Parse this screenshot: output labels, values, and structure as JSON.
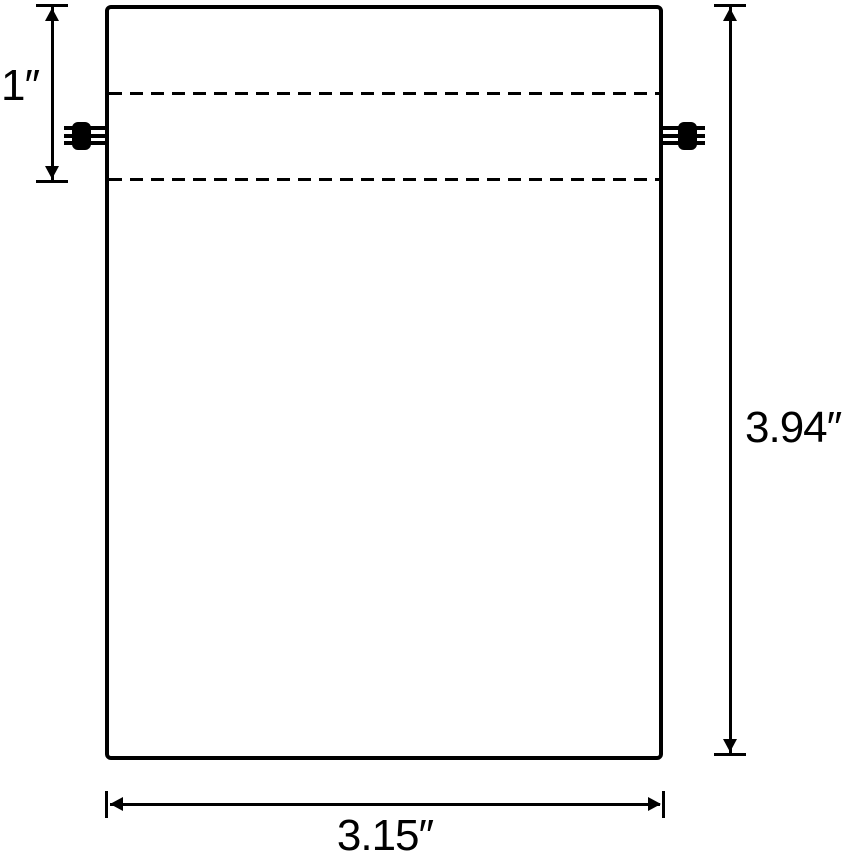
{
  "diagram": {
    "type": "product-dimension-diagram",
    "subject": "drawstring bag pouch with two cord-lock toggles and drawstring channel",
    "background_color": "#ffffff",
    "line_color": "#000000",
    "labels": {
      "channel_height": "1″",
      "bag_height": "3.94″",
      "bag_width": "3.15″"
    },
    "dimensions": {
      "channel_height_inches": 1,
      "bag_height_inches": 3.94,
      "bag_width_inches": 3.15
    }
  }
}
